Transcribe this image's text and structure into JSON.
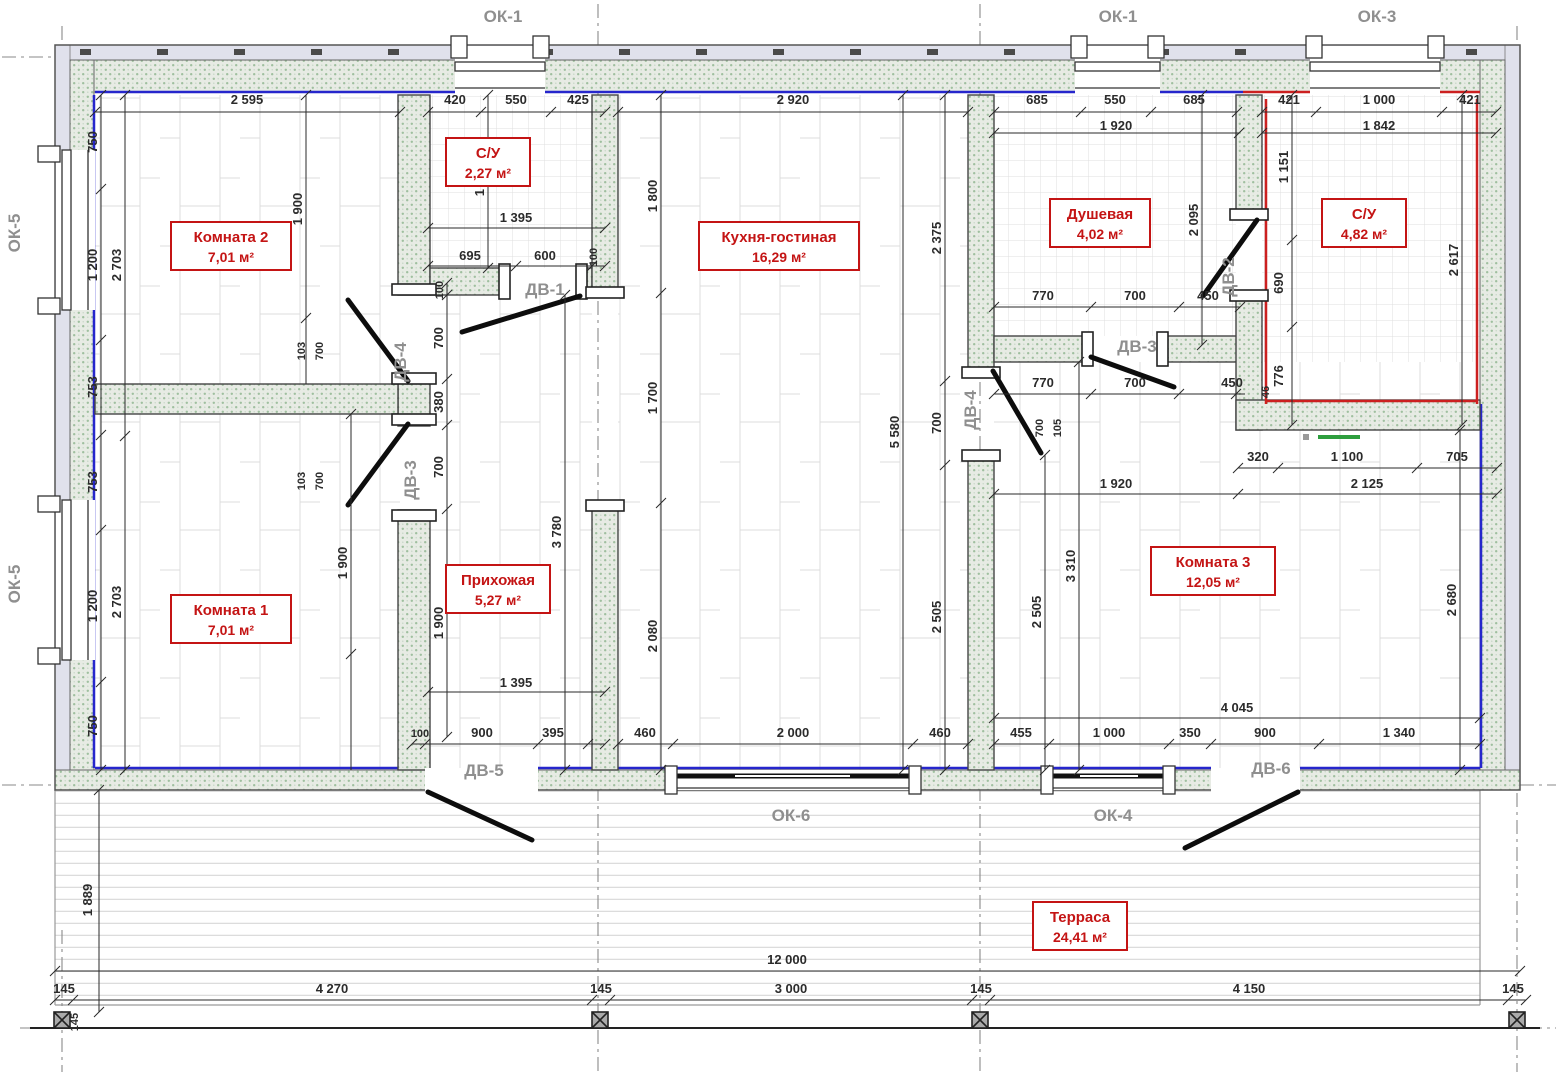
{
  "drawing_type": "architectural floor plan",
  "colors": {
    "room_label_red": "#c41414",
    "inner_wall_line_blue": "#2626cc",
    "inner_wall_line_red": "#cc2020",
    "wall_hatch_green": "#9fbf9f",
    "opening_label_gray": "#8f8f8f",
    "dimension_text": "#2b2b2b",
    "legend_mark_green": "#2e9e3e"
  },
  "rooms": [
    {
      "name": "Комната 2",
      "area": "7,01 м²"
    },
    {
      "name": "С/У",
      "area": "2,27 м²"
    },
    {
      "name": "Кухня-гостиная",
      "area": "16,29 м²"
    },
    {
      "name": "Душевая",
      "area": "4,02 м²"
    },
    {
      "name": "С/У",
      "area": "4,82 м²"
    },
    {
      "name": "Комната 1",
      "area": "7,01 м²"
    },
    {
      "name": "Прихожая",
      "area": "5,27 м²"
    },
    {
      "name": "Комната 3",
      "area": "12,05 м²"
    },
    {
      "name": "Терраса",
      "area": "24,41 м²"
    }
  ],
  "opening_labels": [
    "ОК-1",
    "ОК-1",
    "ОК-3",
    "ОК-5",
    "ОК-5",
    "ДВ-1",
    "ДВ-2",
    "ДВ-3",
    "ДВ-4",
    "ДВ-3",
    "ДВ-4",
    "ДВ-5",
    "ОК-6",
    "ОК-4",
    "ДВ-6"
  ],
  "dims": [
    "2 595",
    "420",
    "550",
    "425",
    "2 920",
    "685",
    "550",
    "685",
    "421",
    "1 000",
    "421",
    "1 920",
    "1 842",
    "750",
    "1 200",
    "753",
    "753",
    "1 200",
    "750",
    "2 703",
    "2 703",
    "1 900",
    "103",
    "700",
    "103",
    "700",
    "1 900",
    "1 625",
    "1 395",
    "695",
    "600",
    "100",
    "100",
    "700",
    "380",
    "700",
    "1 900",
    "3 780",
    "1 395",
    "1 800",
    "1 700",
    "2 080",
    "5 580",
    "2 375",
    "700",
    "2 505",
    "2 505",
    "3 310",
    "2 095",
    "770",
    "700",
    "450",
    "770",
    "700",
    "450",
    "700",
    "105",
    "1 151",
    "690",
    "776",
    "46",
    "2 617",
    "320",
    "1 100",
    "705",
    "2 125",
    "1 920",
    "2 680",
    "100",
    "900",
    "395",
    "460",
    "2 000",
    "460",
    "455",
    "1 000",
    "350",
    "900",
    "1 340",
    "4 045",
    "1 889",
    "12 000",
    "145",
    "4 270",
    "145",
    "3 000",
    "145",
    "4 150",
    "145",
    "145"
  ]
}
